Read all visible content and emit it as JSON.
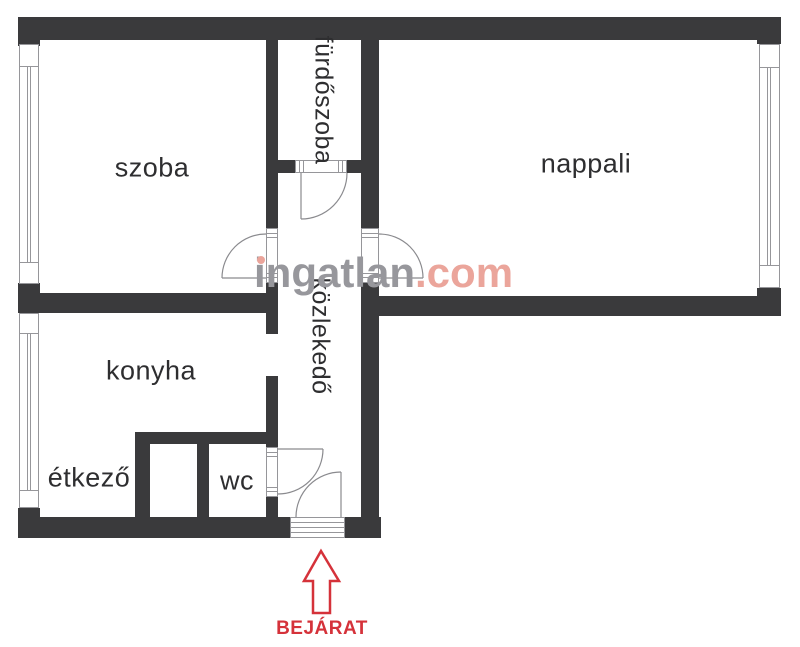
{
  "plan": {
    "title": "apartment-floor-plan",
    "labels": {
      "szoba": "szoba",
      "nappali": "nappali",
      "konyha": "konyha",
      "etkezo": "étkező",
      "wc": "wc",
      "furdoszoba": "fürdőszoba",
      "kozlekedo": "közlekedő"
    },
    "entrance": {
      "label": "BEJÁRAT"
    },
    "watermark": {
      "brand": "ingatlan",
      "tld": ".com"
    },
    "colors": {
      "background": "#ffffff",
      "wall": "#3a3a3c",
      "thin_line": "#96969a",
      "room_text": "#2e2e30",
      "watermark_gray": "#97979c",
      "watermark_accent": "#eba59b",
      "entrance_red": "#d5323a"
    }
  }
}
